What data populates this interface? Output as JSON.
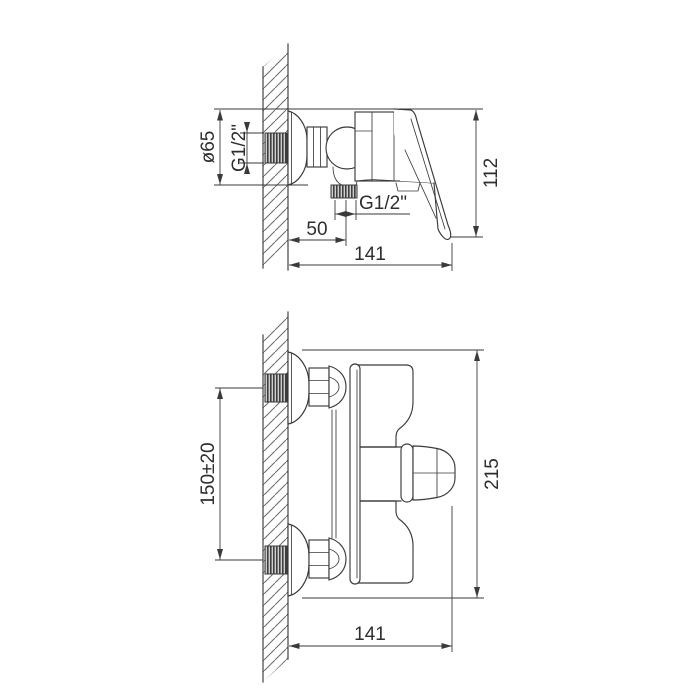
{
  "page": {
    "background": "#ffffff",
    "line_color": "#3a3a3a"
  },
  "top_view": {
    "name": "side view",
    "labels": {
      "flange_diameter": "ø65",
      "wall_thread": "G1/2\"",
      "outlet_thread": "G1/2\"",
      "outlet_offset": "50",
      "depth": "141",
      "height": "112"
    }
  },
  "bottom_view": {
    "name": "front view",
    "labels": {
      "connection_centers": "150±20",
      "overall_width": "215",
      "depth": "141"
    }
  }
}
